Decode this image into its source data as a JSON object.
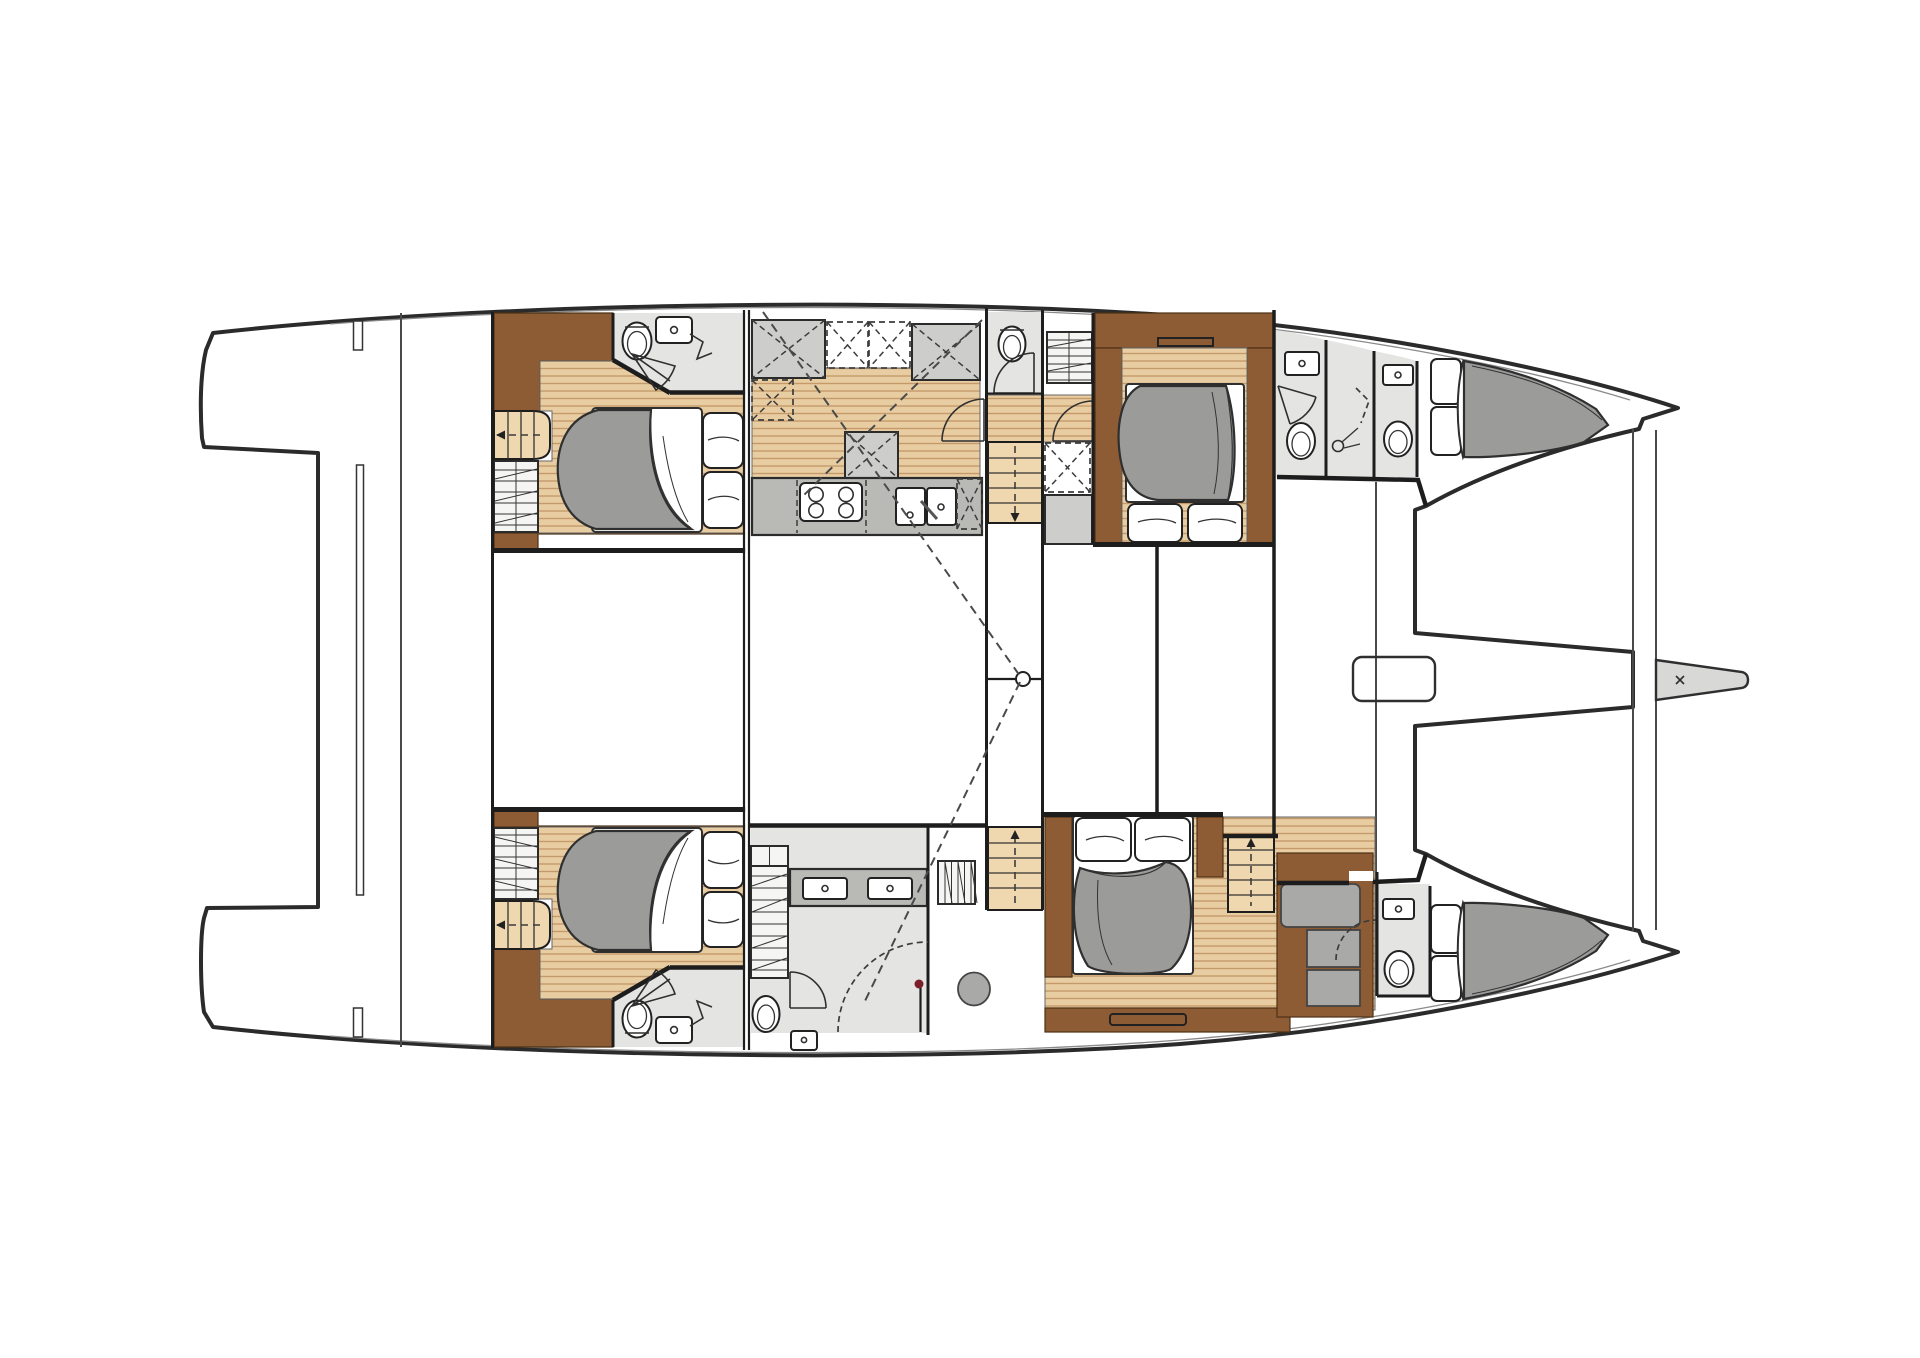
{
  "canvas": {
    "width": 1920,
    "height": 1358
  },
  "colors": {
    "background": "#ffffff",
    "outline": "#2b2b2b",
    "wall": "#1d1d1d",
    "deck": "#d8d9d6",
    "room_floor": "#e4e5e2",
    "wood_base": "#e9cda2",
    "wood_line": "#c49a6a",
    "wood_stairs": "#efd7b0",
    "brown": "#8d5c35",
    "counter": "#b9bab6",
    "cabinet": "#cdcecb",
    "cabinet_light": "#ececea",
    "duvet": "#9b9c99",
    "linen": "#ffffff",
    "dash": "#4a4a4a",
    "accent_dot": "#7c1d2a"
  },
  "features": {
    "double_beds": 4,
    "bow_berths": 2,
    "toilets": 7,
    "washbasins": 8,
    "galley_sink_basins": 2,
    "stove_burners": 4,
    "shower_stalls": 4,
    "staircases": 5,
    "deck_hatches": 1,
    "under_bed_drawers": 1
  }
}
